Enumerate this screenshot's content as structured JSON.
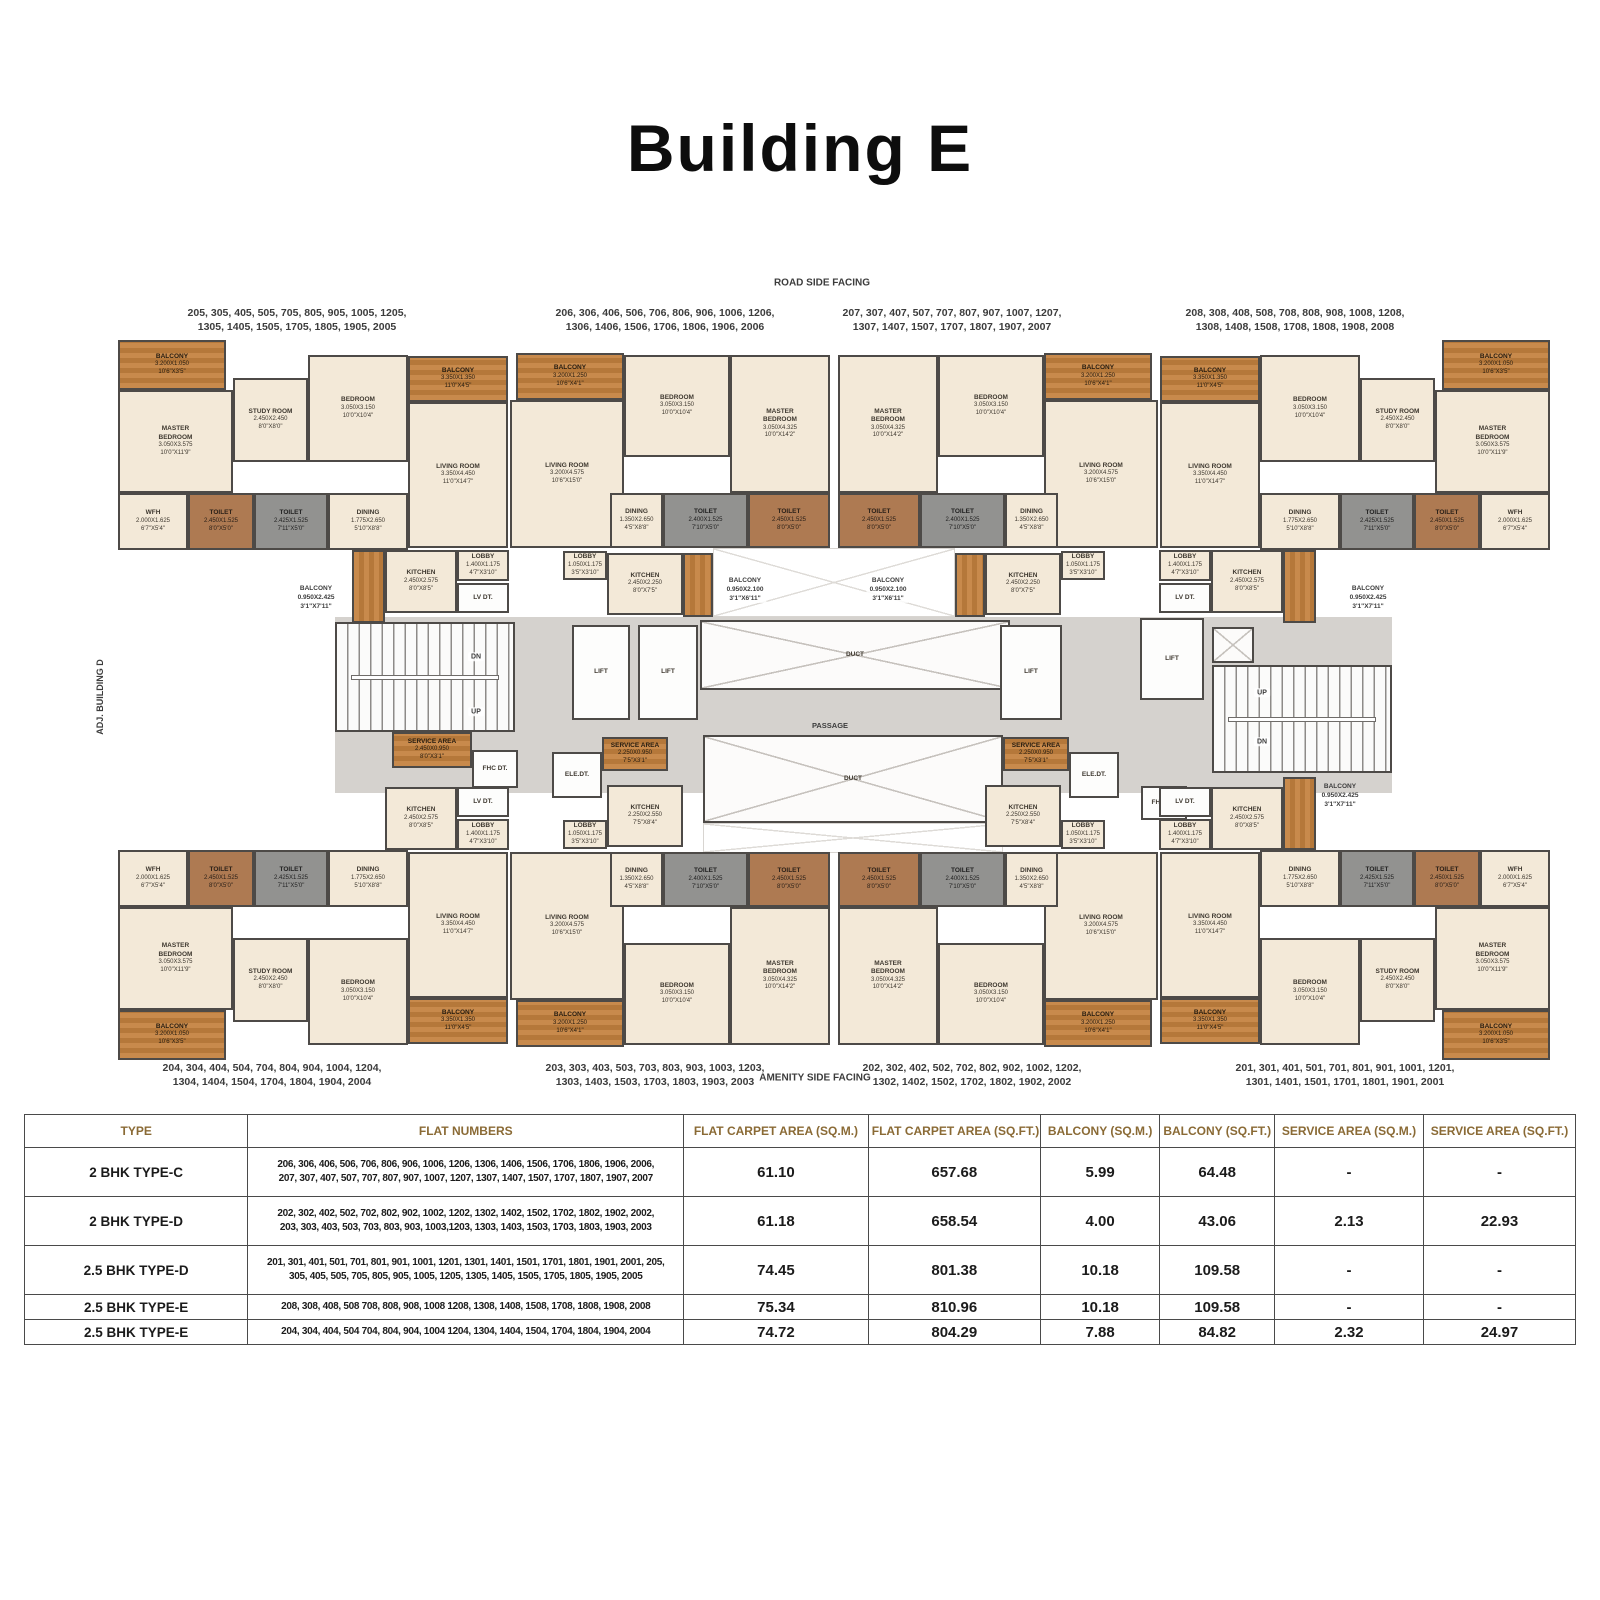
{
  "title": "Building E",
  "plan": {
    "mirror_x_sum": 1668,
    "mirror_y_sum": 1400,
    "units": {
      "A": [
        {
          "id": "balcony",
          "t": "balc",
          "x": 118,
          "y": 340,
          "w": 108,
          "h": 50,
          "n": [
            "BALCONY",
            "3.200X1.050",
            "10'6\"X3'5\""
          ]
        },
        {
          "id": "master-bedroom",
          "t": "room",
          "x": 118,
          "y": 390,
          "w": 115,
          "h": 103,
          "n": [
            "MASTER",
            "BEDROOM",
            "3.050X3.575",
            "10'0\"X11'9\""
          ]
        },
        {
          "id": "study-room",
          "t": "room",
          "x": 233,
          "y": 378,
          "w": 75,
          "h": 84,
          "n": [
            "STUDY ROOM",
            "2.450X2.450",
            "8'0\"X8'0\""
          ]
        },
        {
          "id": "bedroom",
          "t": "room",
          "x": 308,
          "y": 355,
          "w": 100,
          "h": 107,
          "n": [
            "BEDROOM",
            "3.050X3.150",
            "10'0\"X10'4\""
          ]
        },
        {
          "id": "balcony-2",
          "t": "balc",
          "x": 408,
          "y": 356,
          "w": 100,
          "h": 46,
          "n": [
            "BALCONY",
            "3.350X1.350",
            "11'0\"X4'5\""
          ]
        },
        {
          "id": "living-room",
          "t": "room",
          "x": 408,
          "y": 402,
          "w": 100,
          "h": 146,
          "n": [
            "LIVING ROOM",
            "3.350X4.450",
            "11'0\"X14'7\""
          ]
        },
        {
          "id": "wfh",
          "t": "room",
          "x": 118,
          "y": 493,
          "w": 70,
          "h": 57,
          "n": [
            "WFH",
            "2.000X1.625",
            "6'7\"X5'4\""
          ]
        },
        {
          "id": "toilet-1",
          "t": "toilb",
          "x": 188,
          "y": 493,
          "w": 66,
          "h": 57,
          "n": [
            "TOILET",
            "2.450X1.525",
            "8'0\"X5'0\""
          ]
        },
        {
          "id": "toilet-2",
          "t": "toilg",
          "x": 254,
          "y": 493,
          "w": 74,
          "h": 57,
          "n": [
            "TOILET",
            "2.425X1.525",
            "7'11\"X5'0\""
          ]
        },
        {
          "id": "dining",
          "t": "room",
          "x": 328,
          "y": 493,
          "w": 80,
          "h": 57,
          "n": [
            "DINING",
            "1.775X2.650",
            "5'10\"X8'8\""
          ]
        },
        {
          "id": "kitchen",
          "t": "room",
          "x": 385,
          "y": 550,
          "w": 72,
          "h": 63,
          "n": [
            "KITCHEN",
            "2.450X2.575",
            "8'0\"X8'5\""
          ]
        },
        {
          "id": "balcony-3",
          "t": "balcv",
          "x": 352,
          "y": 550,
          "w": 33,
          "h": 73,
          "n": []
        },
        {
          "id": "lobby",
          "t": "room",
          "x": 457,
          "y": 550,
          "w": 52,
          "h": 31,
          "n": [
            "LOBBY",
            "1.400X1.175",
            "4'7\"X3'10\""
          ]
        },
        {
          "id": "lv-dt",
          "t": "white",
          "x": 457,
          "y": 583,
          "w": 52,
          "h": 30,
          "n": [
            "LV DT."
          ]
        }
      ],
      "B": [
        {
          "id": "balcony",
          "t": "balc",
          "x": 516,
          "y": 353,
          "w": 108,
          "h": 47,
          "n": [
            "BALCONY",
            "3.200X1.250",
            "10'6\"X4'1\""
          ]
        },
        {
          "id": "living-room",
          "t": "room",
          "x": 510,
          "y": 400,
          "w": 114,
          "h": 148,
          "n": [
            "LIVING ROOM",
            "3.200X4.575",
            "10'6\"X15'0\""
          ]
        },
        {
          "id": "bedroom",
          "t": "room",
          "x": 624,
          "y": 355,
          "w": 106,
          "h": 102,
          "n": [
            "BEDROOM",
            "3.050X3.150",
            "10'0\"X10'4\""
          ]
        },
        {
          "id": "master-bedroom",
          "t": "room",
          "x": 730,
          "y": 355,
          "w": 100,
          "h": 138,
          "n": [
            "MASTER",
            "BEDROOM",
            "3.050X4.325",
            "10'0\"X14'2\""
          ]
        },
        {
          "id": "dining",
          "t": "room",
          "x": 610,
          "y": 493,
          "w": 53,
          "h": 55,
          "n": [
            "DINING",
            "1.350X2.650",
            "4'5\"X8'8\""
          ]
        },
        {
          "id": "toilet-1",
          "t": "toilg",
          "x": 663,
          "y": 493,
          "w": 85,
          "h": 55,
          "n": [
            "TOILET",
            "2.400X1.525",
            "7'10\"X5'0\""
          ]
        },
        {
          "id": "toilet-2",
          "t": "toilb",
          "x": 748,
          "y": 493,
          "w": 82,
          "h": 55,
          "n": [
            "TOILET",
            "2.450X1.525",
            "8'0\"X5'0\""
          ]
        },
        {
          "id": "lobby",
          "t": "room",
          "x": 563,
          "y": 551,
          "w": 44,
          "h": 29,
          "n": [
            "LOBBY",
            "1.050X1.175",
            "3'5\"X3'10\""
          ]
        },
        {
          "id": "kitchen",
          "t": "room",
          "x": 607,
          "y": 553,
          "w": 76,
          "h": 62,
          "n": [
            "KITCHEN",
            "2.450X2.250",
            "8'0\"X7'5\""
          ]
        },
        {
          "id": "balcony-3",
          "t": "balcv",
          "x": 683,
          "y": 553,
          "w": 30,
          "h": 64,
          "n": []
        }
      ]
    },
    "instances": [
      {
        "name": "unit-top-left-205",
        "unit": "A",
        "mx": false,
        "my": false
      },
      {
        "name": "unit-top-midleft-206",
        "unit": "B",
        "mx": false,
        "my": false
      },
      {
        "name": "unit-top-midright-207",
        "unit": "B",
        "mx": true,
        "my": false
      },
      {
        "name": "unit-top-right-208",
        "unit": "A",
        "mx": true,
        "my": false
      },
      {
        "name": "unit-bottom-left-204",
        "unit": "A",
        "mx": false,
        "my": true,
        "exclude": [
          11
        ]
      },
      {
        "name": "unit-bottom-midleft-203",
        "unit": "B",
        "mx": false,
        "my": true,
        "exclude": [
          9
        ],
        "replace": {
          "8": [
            "KITCHEN",
            "2.250X2.550",
            "7'5\"X8'4\""
          ]
        }
      },
      {
        "name": "unit-bottom-midright-202",
        "unit": "B",
        "mx": true,
        "my": true,
        "exclude": [
          9
        ],
        "replace": {
          "8": [
            "KITCHEN",
            "2.250X2.550",
            "7'5\"X8'4\""
          ]
        }
      },
      {
        "name": "unit-bottom-right-201",
        "unit": "A",
        "mx": true,
        "my": true
      }
    ],
    "core": [
      {
        "id": "circulation-band",
        "t": "gray",
        "x": 335,
        "y": 617,
        "w": 1057,
        "h": 176,
        "n": []
      },
      {
        "id": "hatch-top",
        "t": "hatch",
        "x": 713,
        "y": 548,
        "w": 242,
        "h": 69,
        "n": []
      },
      {
        "id": "hatch-bottom",
        "t": "hatch",
        "x": 703,
        "y": 823,
        "w": 300,
        "h": 30,
        "n": []
      },
      {
        "id": "stair-left",
        "t": "stair",
        "x": 335,
        "y": 622,
        "w": 180,
        "h": 110,
        "n": []
      },
      {
        "id": "service-area-left",
        "t": "balc",
        "x": 392,
        "y": 732,
        "w": 80,
        "h": 36,
        "n": [
          "SERVICE AREA",
          "2.450X0.950",
          "8'0\"X3'1\""
        ]
      },
      {
        "id": "fhc-dt-left",
        "t": "white",
        "x": 472,
        "y": 750,
        "w": 46,
        "h": 38,
        "n": [
          "FHC DT."
        ]
      },
      {
        "id": "lift-1",
        "t": "lift",
        "x": 572,
        "y": 625,
        "w": 58,
        "h": 95,
        "n": [
          "LIFT"
        ]
      },
      {
        "id": "lift-2",
        "t": "lift",
        "x": 638,
        "y": 625,
        "w": 60,
        "h": 95,
        "n": [
          "LIFT"
        ]
      },
      {
        "id": "duct-top",
        "t": "duct",
        "x": 700,
        "y": 620,
        "w": 310,
        "h": 70,
        "n": [
          "DUCT"
        ]
      },
      {
        "id": "ele-dt-left",
        "t": "white",
        "x": 552,
        "y": 752,
        "w": 50,
        "h": 46,
        "n": [
          "ELE.DT."
        ]
      },
      {
        "id": "service-area-centerleft",
        "t": "balc",
        "x": 602,
        "y": 737,
        "w": 66,
        "h": 34,
        "n": [
          "SERVICE AREA",
          "2.250X0.950",
          "7'5\"X3'1\""
        ]
      },
      {
        "id": "duct-bottom",
        "t": "duct",
        "x": 703,
        "y": 735,
        "w": 300,
        "h": 88,
        "n": [
          "DUCT"
        ]
      },
      {
        "id": "service-area-centerright",
        "t": "balc",
        "x": 1003,
        "y": 737,
        "w": 66,
        "h": 34,
        "n": [
          "SERVICE AREA",
          "2.250X0.950",
          "7'5\"X3'1\""
        ]
      },
      {
        "id": "ele-dt-right",
        "t": "white",
        "x": 1069,
        "y": 752,
        "w": 50,
        "h": 46,
        "n": [
          "ELE.DT."
        ]
      },
      {
        "id": "lift-3",
        "t": "lift",
        "x": 1000,
        "y": 625,
        "w": 62,
        "h": 95,
        "n": [
          "LIFT"
        ]
      },
      {
        "id": "lift-4",
        "t": "lift",
        "x": 1140,
        "y": 618,
        "w": 64,
        "h": 82,
        "n": [
          "LIFT"
        ]
      },
      {
        "id": "duct-small",
        "t": "duct",
        "x": 1212,
        "y": 627,
        "w": 42,
        "h": 36,
        "n": []
      },
      {
        "id": "stair-right",
        "t": "stair",
        "x": 1212,
        "y": 665,
        "w": 180,
        "h": 108,
        "n": []
      },
      {
        "id": "fhc-dt-right",
        "t": "white",
        "x": 1141,
        "y": 786,
        "w": 46,
        "h": 34,
        "n": [
          "FHC DT."
        ]
      }
    ],
    "texts": [
      {
        "id": "road-side-label",
        "x": 822,
        "y": 283,
        "fs": 10,
        "lines": [
          "ROAD SIDE FACING"
        ]
      },
      {
        "id": "amenity-side-label",
        "x": 815,
        "y": 1078,
        "fs": 10,
        "lines": [
          "AMENITY SIDE FACING"
        ]
      },
      {
        "id": "adj-building-label",
        "x": 100,
        "y": 697,
        "fs": 9,
        "rot": -90,
        "lines": [
          "ADJ. BUILDING D"
        ]
      },
      {
        "id": "flat-group-top-1",
        "x": 297,
        "y": 320,
        "fs": 10.5,
        "lines": [
          "205, 305, 405, 505, 705, 805, 905, 1005, 1205,",
          "1305, 1405, 1505, 1705, 1805, 1905, 2005"
        ]
      },
      {
        "id": "flat-group-top-2",
        "x": 665,
        "y": 320,
        "fs": 10.5,
        "lines": [
          "206, 306, 406, 506, 706, 806, 906, 1006, 1206,",
          "1306, 1406, 1506, 1706, 1806, 1906, 2006"
        ]
      },
      {
        "id": "flat-group-top-3",
        "x": 952,
        "y": 320,
        "fs": 10.5,
        "lines": [
          "207, 307, 407, 507, 707, 807, 907, 1007, 1207,",
          "1307, 1407, 1507, 1707, 1807, 1907, 2007"
        ]
      },
      {
        "id": "flat-group-top-4",
        "x": 1295,
        "y": 320,
        "fs": 10.5,
        "lines": [
          "208, 308, 408, 508, 708, 808, 908, 1008, 1208,",
          "1308, 1408, 1508, 1708, 1808, 1908, 2008"
        ]
      },
      {
        "id": "flat-group-bottom-1",
        "x": 272,
        "y": 1075,
        "fs": 10.5,
        "lines": [
          "204, 304, 404, 504, 704, 804, 904, 1004, 1204,",
          "1304, 1404, 1504, 1704, 1804, 1904, 2004"
        ]
      },
      {
        "id": "flat-group-bottom-2",
        "x": 655,
        "y": 1075,
        "fs": 10.5,
        "lines": [
          "203, 303, 403, 503, 703, 803, 903, 1003, 1203,",
          "1303, 1403, 1503, 1703, 1803, 1903, 2003"
        ]
      },
      {
        "id": "flat-group-bottom-3",
        "x": 972,
        "y": 1075,
        "fs": 10.5,
        "lines": [
          "202, 302, 402, 502, 702, 802, 902, 1002, 1202,",
          "1302, 1402, 1502, 1702, 1802, 1902, 2002"
        ]
      },
      {
        "id": "flat-group-bottom-4",
        "x": 1345,
        "y": 1075,
        "fs": 10.5,
        "lines": [
          "201, 301, 401, 501, 701, 801, 901, 1001, 1201,",
          "1301, 1401, 1501, 1701, 1801, 1901, 2001"
        ]
      },
      {
        "id": "balcony-note-top-left",
        "x": 316,
        "y": 598,
        "fs": 6.5,
        "lines": [
          "BALCONY",
          "0.950X2.425",
          "3'1\"X7'11\""
        ]
      },
      {
        "id": "balcony-note-top-right",
        "x": 1368,
        "y": 598,
        "fs": 6.5,
        "lines": [
          "BALCONY",
          "0.950X2.425",
          "3'1\"X7'11\""
        ]
      },
      {
        "id": "balcony-note-center-left",
        "x": 745,
        "y": 590,
        "fs": 6.5,
        "bg": true,
        "lines": [
          "BALCONY",
          "0.950X2.100",
          "3'1\"X6'11\""
        ]
      },
      {
        "id": "balcony-note-center-right",
        "x": 888,
        "y": 590,
        "fs": 6.5,
        "bg": true,
        "lines": [
          "BALCONY",
          "0.950X2.100",
          "3'1\"X6'11\""
        ]
      },
      {
        "id": "balcony-note-bottom-right",
        "x": 1340,
        "y": 796,
        "fs": 6.5,
        "lines": [
          "BALCONY",
          "0.950X2.425",
          "3'1\"X7'11\""
        ]
      },
      {
        "id": "stair-left-dn-label",
        "x": 476,
        "y": 657,
        "fs": 7,
        "bg": true,
        "lines": [
          "DN"
        ]
      },
      {
        "id": "stair-left-up-label",
        "x": 476,
        "y": 712,
        "fs": 7,
        "bg": true,
        "lines": [
          "UP"
        ]
      },
      {
        "id": "stair-right-up-label",
        "x": 1262,
        "y": 693,
        "fs": 7,
        "bg": true,
        "lines": [
          "UP"
        ]
      },
      {
        "id": "stair-right-dn-label",
        "x": 1262,
        "y": 742,
        "fs": 7,
        "bg": true,
        "lines": [
          "DN"
        ]
      },
      {
        "id": "passage-label",
        "x": 830,
        "y": 726,
        "fs": 7.5,
        "lines": [
          "PASSAGE"
        ]
      }
    ]
  },
  "table": {
    "headers": [
      "TYPE",
      "FLAT NUMBERS",
      "FLAT CARPET AREA (SQ.M.)",
      "FLAT CARPET AREA (SQ.FT.)",
      "BALCONY (SQ.M.)",
      "BALCONY (SQ.FT.)",
      "SERVICE AREA (SQ.M.)",
      "SERVICE AREA (SQ.FT.)"
    ],
    "col_widths": [
      14.4,
      28.1,
      11.9,
      11.1,
      7.7,
      7.4,
      9.6,
      9.8
    ],
    "rows": [
      {
        "type": "2 BHK TYPE-C",
        "flats": [
          "206, 306, 406, 506, 706, 806, 906, 1006, 1206, 1306, 1406, 1506, 1706, 1806, 1906, 2006,",
          "207, 307, 407, 507, 707, 807, 907, 1007, 1207, 1307, 1407, 1507, 1707, 1807, 1907, 2007"
        ],
        "carpet_sqm": "61.10",
        "carpet_sqft": "657.68",
        "balcony_sqm": "5.99",
        "balcony_sqft": "64.48",
        "service_sqm": "-",
        "service_sqft": "-"
      },
      {
        "type": "2 BHK TYPE-D",
        "flats": [
          "202, 302, 402, 502, 702, 802, 902, 1002, 1202, 1302, 1402, 1502, 1702, 1802, 1902, 2002,",
          "203, 303, 403, 503, 703, 803, 903, 1003,1203, 1303, 1403, 1503, 1703, 1803, 1903, 2003"
        ],
        "carpet_sqm": "61.18",
        "carpet_sqft": "658.54",
        "balcony_sqm": "4.00",
        "balcony_sqft": "43.06",
        "service_sqm": "2.13",
        "service_sqft": "22.93"
      },
      {
        "type": "2.5 BHK TYPE-D",
        "flats": [
          "201, 301, 401, 501, 701, 801, 901, 1001, 1201, 1301, 1401, 1501, 1701, 1801, 1901, 2001, 205,",
          "305, 405, 505, 705, 805, 905, 1005, 1205, 1305, 1405, 1505, 1705, 1805, 1905, 2005"
        ],
        "carpet_sqm": "74.45",
        "carpet_sqft": "801.38",
        "balcony_sqm": "10.18",
        "balcony_sqft": "109.58",
        "service_sqm": "-",
        "service_sqft": "-"
      },
      {
        "type": "2.5 BHK TYPE-E",
        "flats": [
          "208, 308, 408, 508 708, 808, 908, 1008 1208, 1308, 1408, 1508, 1708, 1808, 1908, 2008"
        ],
        "carpet_sqm": "75.34",
        "carpet_sqft": "810.96",
        "balcony_sqm": "10.18",
        "balcony_sqft": "109.58",
        "service_sqm": "-",
        "service_sqft": "-"
      },
      {
        "type": "2.5 BHK TYPE-E",
        "flats": [
          "204, 304, 404, 504 704, 804, 904, 1004 1204, 1304, 1404, 1504, 1704, 1804, 1904, 2004"
        ],
        "carpet_sqm": "74.72",
        "carpet_sqft": "804.29",
        "balcony_sqm": "7.88",
        "balcony_sqft": "84.82",
        "service_sqm": "2.32",
        "service_sqft": "24.97"
      }
    ]
  }
}
